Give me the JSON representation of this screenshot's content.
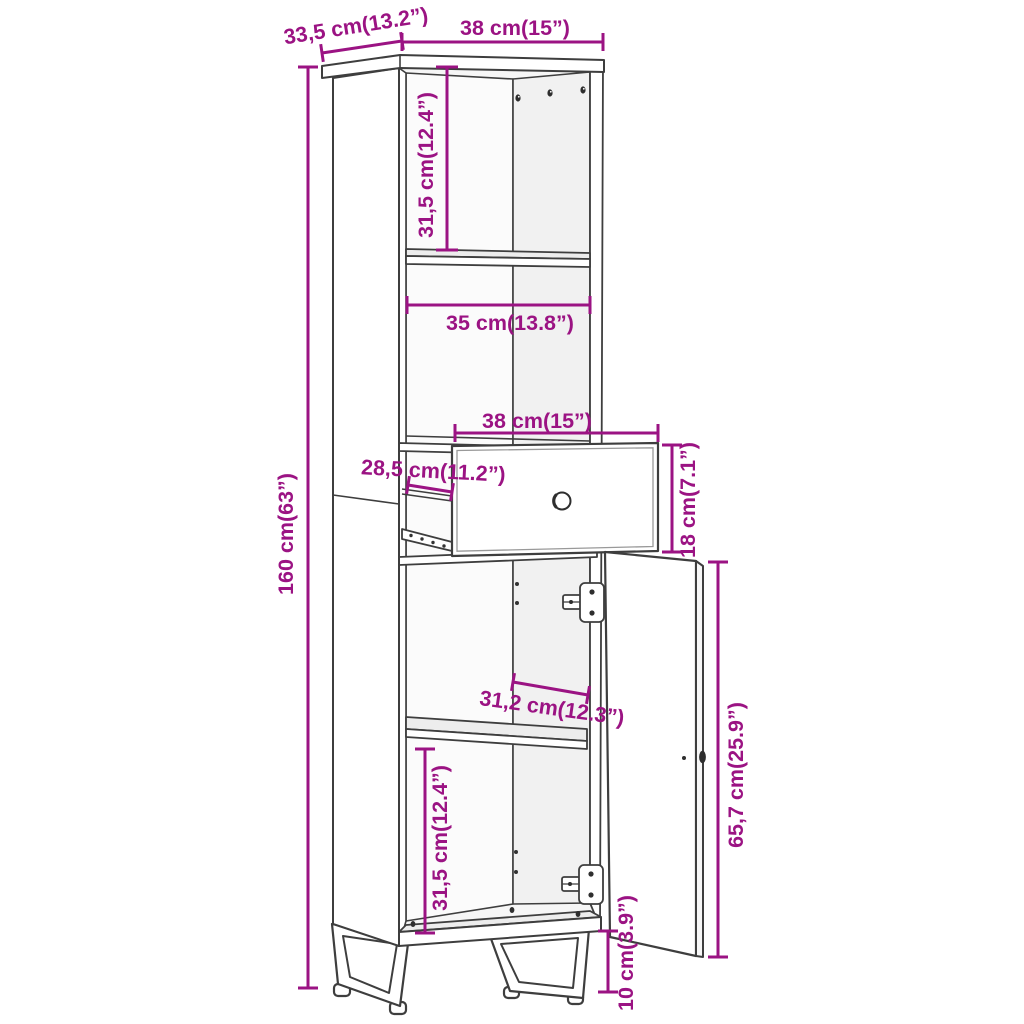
{
  "figure": {
    "title": "Cabinet dimension diagram",
    "item": "Tall narrow cabinet with two open compartments, pull-out drawer, open door and sled legs"
  },
  "style": {
    "dimension_color": "#9B1383",
    "line_color": "#3E3E3E",
    "background": "#FFFFFF"
  },
  "dimensions": {
    "depth_top": {
      "label": "33,5 cm(13.2”)"
    },
    "width_top": {
      "label": "38 cm(15”)"
    },
    "height_overall": {
      "label": "160 cm(63”)"
    },
    "top_compartment_height": {
      "label": "31,5 cm(12.4”)"
    },
    "shelf_width": {
      "label": "35 cm(13.8”)"
    },
    "drawer_width": {
      "label": "38 cm(15”)"
    },
    "drawer_depth": {
      "label": "28,5 cm(11.2”)"
    },
    "drawer_height": {
      "label": "18 cm(7.1”)"
    },
    "door_opening_width": {
      "label": "31,2 cm(12.3”)"
    },
    "door_height": {
      "label": "65,7 cm(25.9”)"
    },
    "bottom_compartment_height": {
      "label": "31,5 cm(12.4”)"
    },
    "leg_height": {
      "label": "10 cm(3.9”)"
    }
  }
}
